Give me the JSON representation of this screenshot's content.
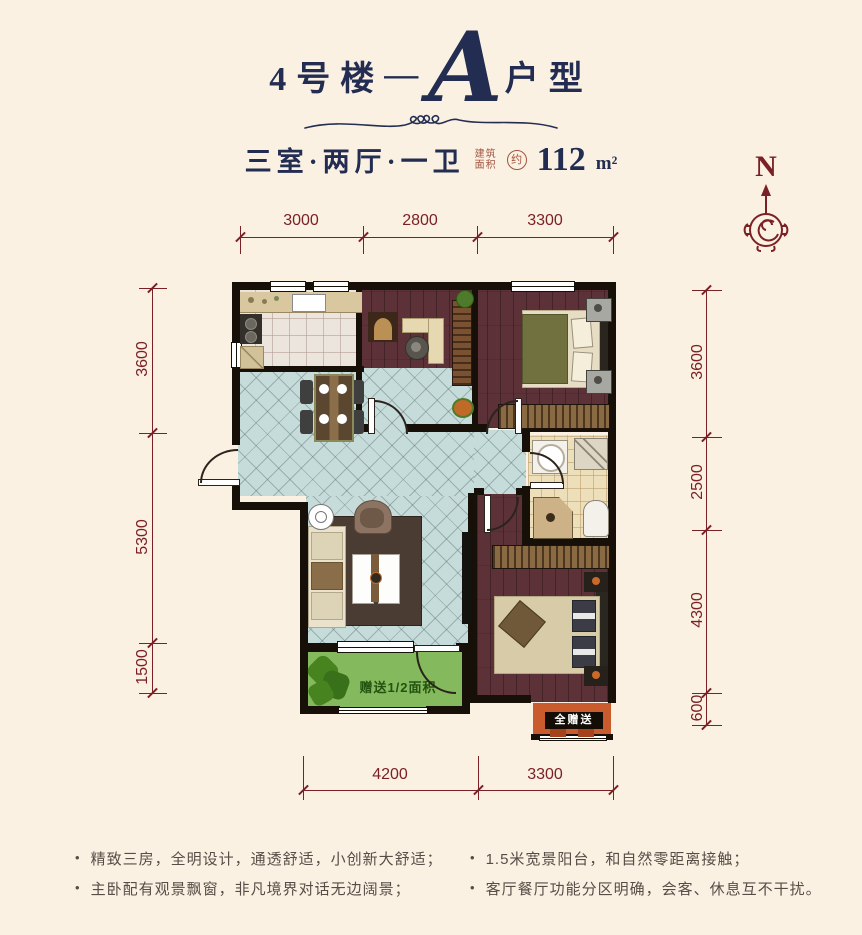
{
  "header": {
    "building": "4号楼",
    "dash": "—",
    "unit_letter": "A",
    "unit_suffix": "户型",
    "layout": "三室·两厅·一卫",
    "area_label_top": "建筑",
    "area_label_bottom": "面积",
    "area_circle": "约",
    "area_value": "112",
    "area_unit": "m²"
  },
  "compass": {
    "north_label": "N"
  },
  "dimensions": {
    "top": [
      "3000",
      "2800",
      "3300"
    ],
    "left": [
      "3600",
      "5300",
      "1500"
    ],
    "right": [
      "3600",
      "2500",
      "4300",
      "600"
    ],
    "bottom": [
      "4200",
      "3300"
    ]
  },
  "plan": {
    "balcony_gift_label": "赠送1/2面积",
    "bay_gift_label": "全赠送"
  },
  "features": {
    "marker": "•",
    "left": [
      "精致三房，全明设计，通透舒适，小创新大舒适；",
      "主卧配有观景飘窗，非凡境界对话无边阔景；"
    ],
    "right": [
      "1.5米宽景阳台，和自然零距离接触；",
      "客厅餐厅功能分区明确，会客、休息互不干扰。"
    ]
  },
  "colors": {
    "background": "#fbf1e3",
    "title_navy": "#232d52",
    "dimension_red": "#7b2125",
    "wall_black": "#171008",
    "wood_floor": "#5d3138",
    "tile_teal": "#c6dcda",
    "balcony_green": "#85b95d",
    "gift_orange": "#c95b2d"
  }
}
